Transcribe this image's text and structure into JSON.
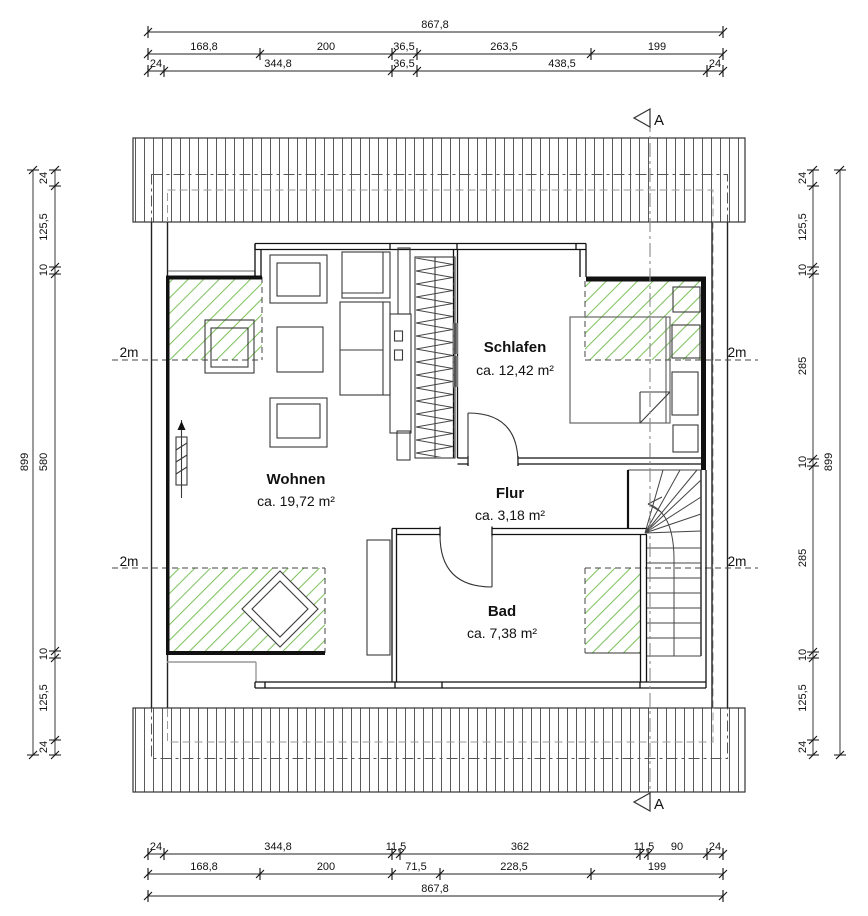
{
  "dimensions": {
    "top": {
      "total": "867,8",
      "row2": [
        "168,8",
        "200",
        "36,5",
        "263,5",
        "199"
      ],
      "row3": [
        "24",
        "344,8",
        "36,5",
        "438,5",
        "24"
      ]
    },
    "bottom": {
      "row1": [
        "24",
        "344,8",
        "11,5",
        "362",
        "11,5",
        "90",
        "24"
      ],
      "row2": [
        "168,8",
        "200",
        "71,5",
        "228,5",
        "199"
      ],
      "total": "867,8"
    },
    "left": {
      "total": "899",
      "segments": [
        "24",
        "125,5",
        "10",
        "580",
        "10",
        "125,5",
        "24"
      ]
    },
    "right": {
      "total": "899",
      "segments": [
        "24",
        "125,5",
        "10",
        "285",
        "10",
        "285",
        "10",
        "125,5",
        "24"
      ]
    }
  },
  "rooms": [
    {
      "name": "Wohnen",
      "area": "ca. 19,72 m²"
    },
    {
      "name": "Schlafen",
      "area": "ca. 12,42 m²"
    },
    {
      "name": "Flur",
      "area": "ca. 3,18 m²"
    },
    {
      "name": "Bad",
      "area": "ca. 7,38 m²"
    }
  ],
  "markers": {
    "section_label": "A",
    "height_line_label": "2m"
  },
  "colors": {
    "hatch_green": "#7fc25f",
    "wall_black": "#111111",
    "secondary_gray": "#999999"
  }
}
